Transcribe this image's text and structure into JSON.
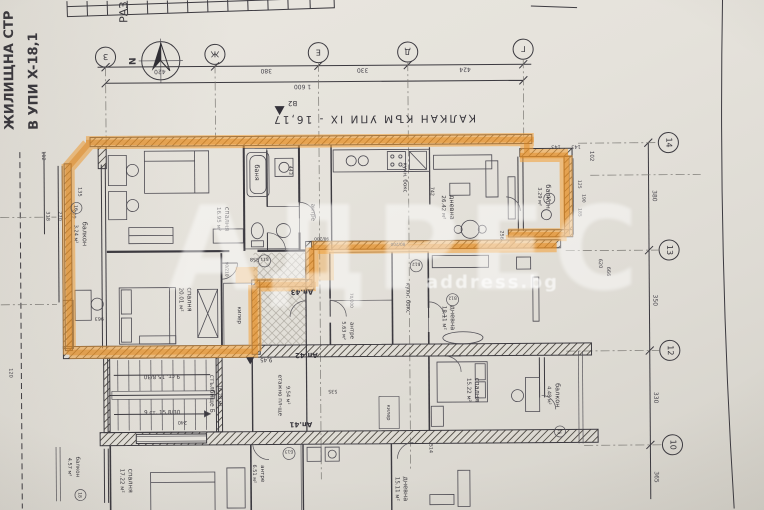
{
  "photo": {
    "side_text": [
      "ЖИЛИЩНА СТР",
      "В УПИ X-18,1",
      "РАЗ"
    ],
    "party_wall_label": "КАЛКАН КЪМ УПИ IX - 16,17",
    "benchmark": "B2",
    "north": "N"
  },
  "watermark": {
    "brand": "АДРЕС",
    "site": "address.bg"
  },
  "apartments": [
    {
      "id": "ap43",
      "label": "Ап.43",
      "highlighted": true,
      "rooms": [
        {
          "name": "спалня",
          "area": "16.95 м²"
        },
        {
          "name": "спалня",
          "area": "20.01 м²"
        },
        {
          "name": "дневна",
          "area": "26.42 м²"
        },
        {
          "name": "балкон",
          "area": "3.24 м²"
        },
        {
          "name": "балкон",
          "area": "3.29 м²"
        },
        {
          "name": "баня",
          "area": ""
        },
        {
          "name": "килер",
          "area": ""
        },
        {
          "name": "антре",
          "area": ""
        },
        {
          "name": "кухн. бокс",
          "area": ""
        }
      ]
    },
    {
      "id": "ap42",
      "label": "Ап.42",
      "highlighted": false,
      "rooms": [
        {
          "name": "дневна",
          "area": "18.11 м²"
        },
        {
          "name": "спалня",
          "area": "15.22 м²"
        },
        {
          "name": "антре",
          "area": "5.63 м²"
        },
        {
          "name": "кухн. бокс",
          "area": ""
        },
        {
          "name": "балкон",
          "area": "4.48 м²"
        }
      ]
    },
    {
      "id": "ap41",
      "label": "Ап.41",
      "highlighted": false,
      "rooms": [
        {
          "name": "спалня",
          "area": "17.22 м²"
        },
        {
          "name": "антре",
          "area": "6.51 м²"
        },
        {
          "name": "балкон",
          "area": "4.57 м²"
        },
        {
          "name": "дневна",
          "area": "15.11 м²"
        }
      ]
    }
  ],
  "common": {
    "stair_name": "стълбище Б",
    "stair_area": "16.28 м²",
    "stair_flight": "9 ст. 15,8/30",
    "landing_name": "етажно пл-ще",
    "landing_area": "9.54 м²",
    "level": "9,45"
  },
  "grid": {
    "top_letters": [
      "З",
      "Ж",
      "Е",
      "Д",
      "Г"
    ],
    "top_dims": [
      "420",
      "380",
      "330",
      "424"
    ],
    "top_total": "1 600",
    "right_numbers": [
      "14",
      "13",
      "12",
      "10"
    ],
    "right_dims": [
      "380",
      "350",
      "330",
      "365"
    ],
    "right_inner_dims": [
      "102",
      "143",
      "143",
      "125",
      "190",
      "185",
      "620",
      "666"
    ],
    "left_dims": [
      "112",
      "135",
      "209",
      "270",
      "318",
      "120"
    ]
  },
  "dims_inner": [
    "443",
    "963",
    "742",
    "256",
    "358",
    "535",
    "240",
    "514",
    "90/200",
    "80/200",
    "70/200",
    "90/210"
  ],
  "door_tags": [
    "16",
    "17",
    "15",
    "18",
    "Б11",
    "Б12",
    "В12",
    "Б13"
  ]
}
